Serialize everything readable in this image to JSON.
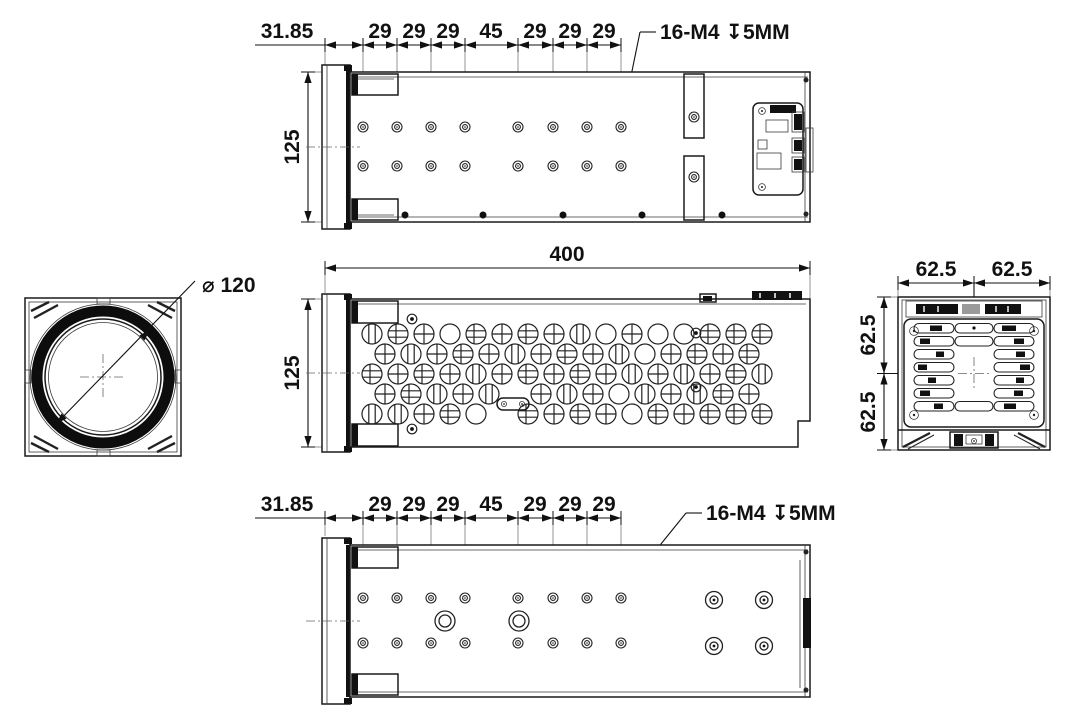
{
  "drawing": {
    "top_view": {
      "chain": [
        "31.85",
        "29",
        "29",
        "29",
        "45",
        "29",
        "29",
        "29"
      ],
      "height": "125",
      "thread_note": "16-M4 ↧5MM"
    },
    "side_view": {
      "length": "400",
      "height": "125"
    },
    "front_view": {
      "lens_diameter": "⌀ 120"
    },
    "rear_view": {
      "width_left": "62.5",
      "width_right": "62.5",
      "height_top": "62.5",
      "height_bottom": "62.5"
    },
    "bottom_view": {
      "chain": [
        "31.85",
        "29",
        "29",
        "29",
        "45",
        "29",
        "29",
        "29"
      ],
      "thread_note": "16-M4 ↧5MM"
    }
  }
}
